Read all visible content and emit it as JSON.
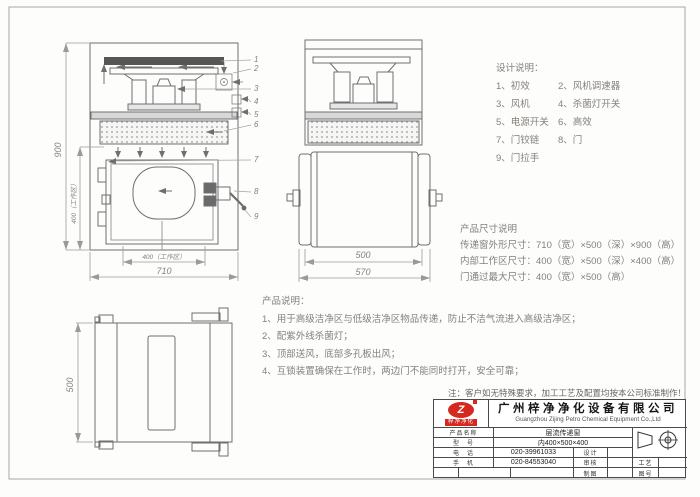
{
  "design_notes": {
    "title": "设计说明：",
    "rows": [
      [
        "1、初效",
        "2、风机调速器"
      ],
      [
        "3、风机",
        "4、杀菌灯开关"
      ],
      [
        "5、电源开关",
        "6、高效"
      ],
      [
        "7、门铰链",
        "8、门"
      ],
      [
        "9、门拉手",
        ""
      ]
    ]
  },
  "size_notes": {
    "title": "产品尺寸说明",
    "lines": [
      "传递窗外形尺寸：710（宽）×500（深）×900（高）",
      "内部工作区尺寸：400（宽）×500（深）×400（高）",
      "门通过最大尺寸：400（宽）×500（高）"
    ]
  },
  "product_notes": {
    "title": "产品说明：",
    "lines": [
      "1、用于高级洁净区与低级洁净区物品传递，防止不洁气流进入高级洁净区；",
      "2、配紫外线杀菌灯；",
      "3、顶部送风，底部多孔板出风；",
      "4、互锁装置确保在工作时，两边门不能同时打开，安全可靠；"
    ]
  },
  "footnote": "注：客户如无特殊要求，加工工艺及配置均按本公司标准制作！",
  "dims": {
    "front_height": "900",
    "work_height": "400（工作区）",
    "work_width": "400（工作区）",
    "front_width": "710",
    "side_inner_width": "500",
    "side_outer_width": "570",
    "top_depth": "500"
  },
  "callouts": [
    "1",
    "2",
    "3",
    "4",
    "5",
    "6",
    "7",
    "8",
    "9"
  ],
  "title_block": {
    "logo_text": "梓净净化",
    "logo_glyph": "Z",
    "company_cn": "广州梓净净化设备有限公司",
    "company_en": "Guangzhou Zijing Petro Chemical Equipment Co.,Ltd",
    "product_label": "产品名称",
    "product_value": "层流传递窗",
    "model_label": "型　号",
    "model_value": "内400×500×400",
    "tel_label": "电　话",
    "tel_value": "020-39961033",
    "mobile_label": "手　机",
    "mobile_value": "020-84553040",
    "design_label": "设计",
    "check_label": "审核",
    "craft_label": "工艺",
    "draw_label": "制图",
    "sheet_label": "图号"
  }
}
